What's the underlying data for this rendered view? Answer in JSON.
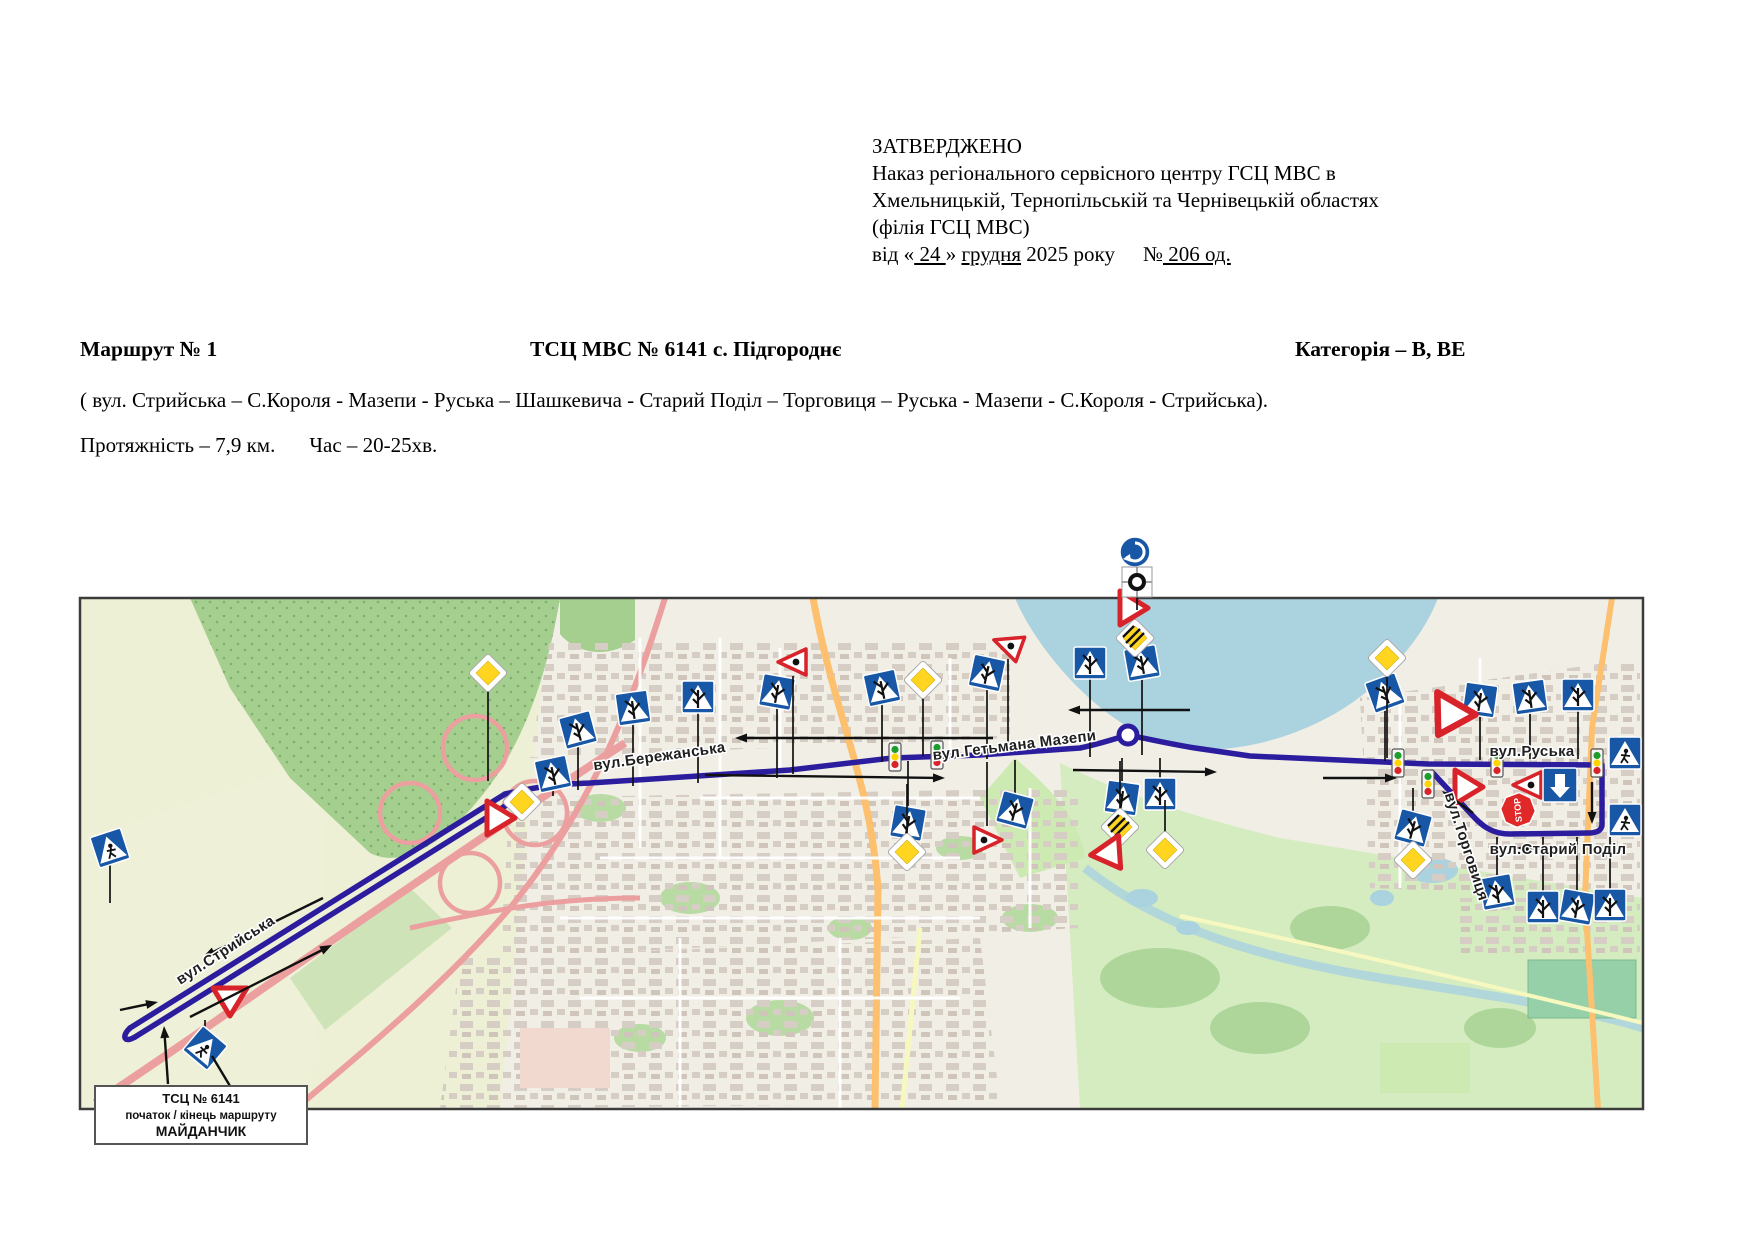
{
  "approval": {
    "l1": "ЗАТВЕРДЖЕНО",
    "l2": "Наказ регіонального сервісного центру ГСЦ МВС в",
    "l3": "Хмельницькій, Тернопільській та Чернівецькій областях",
    "l4": "(філія ГСЦ МВС)",
    "l5a": "від «",
    "l5b": " 24 ",
    "l5c": "» ",
    "l5d": "грудня",
    "l5e": " 2025 року",
    "l5f": "№",
    "l5g": " 206 од."
  },
  "route_header": {
    "left": "Маршрут № 1",
    "center": "ТСЦ МВС № 6141 с. Підгороднє",
    "right": "Категорія – В, ВЕ"
  },
  "route_desc": "( вул. Стрийська – С.Короля - Мазепи - Руська – Шашкевича - Старий Поділ – Торговиця – Руська - Мазепи - С.Короля - Стрийська).",
  "route_stats": {
    "length": "Протяжність – 7,9 км.",
    "time": "Час – 20-25хв."
  },
  "map": {
    "colors": {
      "route": "#2b1d9e",
      "sign_blue": "#1757a6",
      "water": "#aad3df",
      "forest": "#a5cf8f",
      "field": "#edf0d4",
      "base": "#f1eee6",
      "motorway": "#ec9f9f",
      "secondary": "#fcc06f",
      "priority_yellow": "#ffd520",
      "stop_red": "#e02828",
      "yield_red": "#d8232a"
    },
    "street_labels": [
      {
        "text": "вул.Стрийська",
        "x": 148,
        "y": 356,
        "rot": -33
      },
      {
        "text": "вул.Бережанська",
        "x": 580,
        "y": 163,
        "rot": -8
      },
      {
        "text": "вул.Гетьмана Мазепи",
        "x": 935,
        "y": 152,
        "rot": -7
      },
      {
        "text": "вул.Руська",
        "x": 1452,
        "y": 158,
        "rot": 0
      },
      {
        "text": "вул.Торговиця",
        "x": 1382,
        "y": 250,
        "rot": 72
      },
      {
        "text": "вул.Старий Поділ",
        "x": 1478,
        "y": 256,
        "rot": 0
      }
    ],
    "start_box": {
      "line1": "ТСЦ № 6141",
      "line2": "початок / кінець маршруту",
      "line3": "МАЙДАНЧИК"
    },
    "stop_text": "STOP",
    "signs": [
      {
        "type": "crossroads",
        "x": 498,
        "y": 132,
        "rot": -15,
        "post": 60
      },
      {
        "type": "crossroads",
        "x": 553,
        "y": 110,
        "rot": -8,
        "post": 78
      },
      {
        "type": "crossroads",
        "x": 618,
        "y": 99,
        "rot": 0,
        "post": 86
      },
      {
        "type": "crossroads",
        "x": 697,
        "y": 94,
        "rot": 10,
        "post": 86
      },
      {
        "type": "crossroads",
        "x": 802,
        "y": 90,
        "rot": -12,
        "post": 74
      },
      {
        "type": "crossroads",
        "x": 907,
        "y": 75,
        "rot": 12,
        "post": 86
      },
      {
        "type": "crossroads",
        "x": 1010,
        "y": 65,
        "rot": 0,
        "post": 94
      },
      {
        "type": "crossroads",
        "x": 1062,
        "y": 65,
        "rot": -10,
        "post": 92
      },
      {
        "type": "crossroads",
        "x": 473,
        "y": 176,
        "rot": -12,
        "post": 22
      },
      {
        "type": "crossroads",
        "x": 828,
        "y": 225,
        "rot": 10,
        "post": -62
      },
      {
        "type": "crossroads",
        "x": 935,
        "y": 212,
        "rot": 15,
        "post": -50
      },
      {
        "type": "crossroads",
        "x": 1080,
        "y": 196,
        "rot": 0,
        "post": -36
      },
      {
        "type": "crossroads",
        "x": 1042,
        "y": 200,
        "rot": 8,
        "post": -40
      },
      {
        "type": "crossroads",
        "x": 1305,
        "y": 95,
        "rot": -20,
        "post": 68
      },
      {
        "type": "crossroads",
        "x": 1400,
        "y": 102,
        "rot": 8,
        "post": 60
      },
      {
        "type": "crossroads",
        "x": 1450,
        "y": 99,
        "rot": -8,
        "post": 62
      },
      {
        "type": "crossroads",
        "x": 1498,
        "y": 97,
        "rot": 0,
        "post": 64
      },
      {
        "type": "crossroads",
        "x": 1333,
        "y": 230,
        "rot": 15,
        "post": -40
      },
      {
        "type": "crossroads",
        "x": 1417,
        "y": 294,
        "rot": -10,
        "post": -55
      },
      {
        "type": "crossroads",
        "x": 1463,
        "y": 309,
        "rot": 0,
        "post": -70
      },
      {
        "type": "crossroads",
        "x": 1497,
        "y": 309,
        "rot": 10,
        "post": -70
      },
      {
        "type": "crossroads",
        "x": 1530,
        "y": 307,
        "rot": 0,
        "post": -68
      },
      {
        "type": "ped",
        "x": 30,
        "y": 250,
        "rot": -18,
        "post": 55
      },
      {
        "type": "ped",
        "x": 125,
        "y": 450,
        "rot": 40,
        "post": -28
      },
      {
        "type": "ped",
        "x": 1545,
        "y": 155,
        "rot": 0,
        "post": 0
      },
      {
        "type": "ped",
        "x": 1545,
        "y": 222,
        "rot": 0,
        "post": 0
      },
      {
        "type": "diamond",
        "x": 408,
        "y": 75,
        "rot": 0,
        "post": 108
      },
      {
        "type": "diamond",
        "x": 843,
        "y": 82,
        "rot": 0,
        "post": 76
      },
      {
        "type": "diamond",
        "x": 1307,
        "y": 60,
        "rot": 0,
        "post": 100
      },
      {
        "type": "diamond",
        "x": 442,
        "y": 204,
        "rot": 0,
        "post": -16
      },
      {
        "type": "diamond",
        "x": 827,
        "y": 254,
        "rot": 0,
        "post": -68
      },
      {
        "type": "diamond",
        "x": 1333,
        "y": 262,
        "rot": 0,
        "post": -18
      },
      {
        "type": "diamond",
        "x": 1085,
        "y": 252,
        "rot": 0,
        "post": -50
      },
      {
        "type": "diamond_end",
        "x": 1040,
        "y": 229,
        "rot": 0,
        "post": -66
      },
      {
        "type": "diamond_end",
        "x": 1055,
        "y": 40,
        "rot": 0,
        "post": 0
      },
      {
        "type": "yield",
        "x": 420,
        "y": 220,
        "rot": -90,
        "post": 0
      },
      {
        "type": "yield",
        "x": 150,
        "y": 403,
        "rot": 0,
        "post": 0
      },
      {
        "type": "yield",
        "x": 1368,
        "y": 120,
        "rot": 30,
        "post": 0,
        "s": 1.3
      },
      {
        "type": "yield",
        "x": 1388,
        "y": 189,
        "rot": -90,
        "post": 0
      },
      {
        "type": "yield",
        "x": 1053,
        "y": 10,
        "rot": -90,
        "post": 0
      },
      {
        "type": "yield",
        "x": 1032,
        "y": 258,
        "rot": -35,
        "post": 0
      },
      {
        "type": "reddot",
        "x": 713,
        "y": 64,
        "rot": 180,
        "post": 112
      },
      {
        "type": "reddot",
        "x": 928,
        "y": 47,
        "rot": 200,
        "post": 100
      },
      {
        "type": "reddot",
        "x": 907,
        "y": 242,
        "rot": 0,
        "post": -78
      },
      {
        "type": "reddot",
        "x": 1448,
        "y": 187,
        "rot": 180,
        "post": 0
      },
      {
        "type": "stop",
        "x": 1438,
        "y": 212,
        "rot": -20,
        "post": 0
      },
      {
        "type": "oneway",
        "x": 1480,
        "y": 187,
        "rot": 0,
        "post": 0
      },
      {
        "type": "rsign",
        "x": 1055,
        "y": -46,
        "rot": 0,
        "post": 0
      },
      {
        "type": "ring",
        "x": 1057,
        "y": -16,
        "rot": 0,
        "post": 28
      },
      {
        "type": "ring_route",
        "x": 1048,
        "y": 137,
        "rot": 0,
        "post": 0
      },
      {
        "type": "tlight",
        "x": 815,
        "y": 159,
        "rot": 0,
        "post": 0
      },
      {
        "type": "tlight",
        "x": 857,
        "y": 157,
        "rot": 0,
        "post": 0
      },
      {
        "type": "tlight",
        "x": 1318,
        "y": 165,
        "rot": 0,
        "post": 0
      },
      {
        "type": "tlight",
        "x": 1417,
        "y": 165,
        "rot": 0,
        "post": 0
      },
      {
        "type": "tlight",
        "x": 1517,
        "y": 165,
        "rot": 0,
        "post": 0
      },
      {
        "type": "tlight",
        "x": 1348,
        "y": 186,
        "rot": 0,
        "post": 0
      }
    ],
    "arrows": [
      {
        "x1": 243,
        "y1": 300,
        "x2": 123,
        "y2": 359
      },
      {
        "x1": 110,
        "y1": 419,
        "x2": 252,
        "y2": 347
      },
      {
        "x1": 913,
        "y1": 140,
        "x2": 655,
        "y2": 140
      },
      {
        "x1": 625,
        "y1": 177,
        "x2": 865,
        "y2": 180
      },
      {
        "x1": 1110,
        "y1": 112,
        "x2": 988,
        "y2": 112
      },
      {
        "x1": 993,
        "y1": 172,
        "x2": 1137,
        "y2": 174
      },
      {
        "x1": 1243,
        "y1": 180,
        "x2": 1317,
        "y2": 180
      },
      {
        "x1": 1480,
        "y1": 250,
        "x2": 1437,
        "y2": 250
      },
      {
        "x1": 1393,
        "y1": 215,
        "x2": 1362,
        "y2": 193
      },
      {
        "x1": 1512,
        "y1": 184,
        "x2": 1512,
        "y2": 226
      },
      {
        "x1": 88,
        "y1": 486,
        "x2": 84,
        "y2": 428
      },
      {
        "x1": 40,
        "y1": 412,
        "x2": 78,
        "y2": 404
      },
      {
        "x1": 150,
        "y1": 488,
        "x2": 132,
        "y2": 458,
        "nohead": true
      }
    ]
  }
}
